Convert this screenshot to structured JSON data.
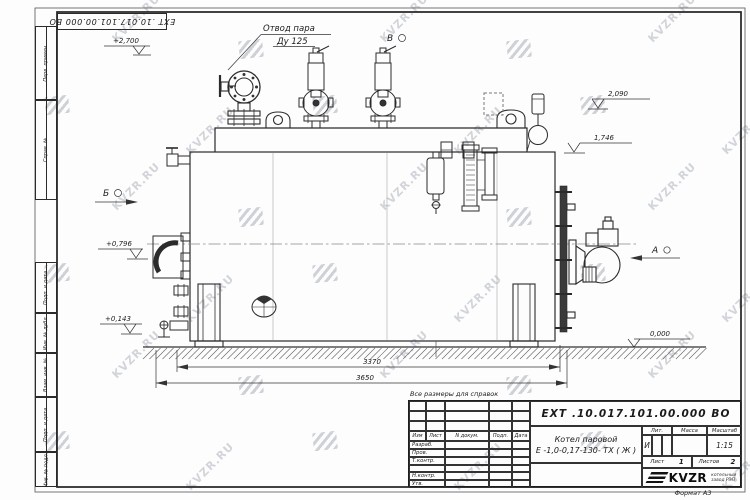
{
  "watermark": {
    "text": "KVZR.RU"
  },
  "top_stamp": {
    "designation": "ЕХТ .10.017.101.00.000  ВО"
  },
  "margin_columns": [
    {
      "label": "Перв. примен."
    },
    {
      "label": "Справ. №"
    },
    {
      "label": "Подп. и дата"
    },
    {
      "label": "Инв. № дубл."
    },
    {
      "label": "Взам. инв. №"
    },
    {
      "label": "Подп. и дата"
    },
    {
      "label": "Инв. № подл."
    }
  ],
  "drawing": {
    "labels": {
      "steam_outlet_line1": "Отвод пара",
      "steam_outlet_line2": "Ду 125",
      "view_a": "А",
      "view_b": "Б",
      "view_v": "В"
    },
    "elevations": {
      "e2700": "+2,700",
      "e2090": "2,090",
      "e1746": "1,746",
      "e0796": "+0,796",
      "e0143": "+0,143",
      "e0000": "0,000"
    },
    "dims": {
      "d3370": "3370",
      "d3650": "3650"
    }
  },
  "note": "Все размеры для справок",
  "title_block": {
    "designation": "ЕХТ .10.017.101.00.000  ВО",
    "product_name_1": "Котел паровой",
    "product_name_2": "Е -1,0-0,17-130- ТХ ( Ж )",
    "rev_header": {
      "izm": "Изм",
      "list": "Лист",
      "ndoc": "N докум.",
      "podp": "Подп.",
      "data": "Дата"
    },
    "row_labels": {
      "razrab": "Разраб.",
      "prov": "Пров.",
      "tkontr": "Т.контр.",
      "nkontr": "Н.контр.",
      "utv": "Утв."
    },
    "lit": {
      "label": "Лит.",
      "value": "И"
    },
    "massa": {
      "label": "Масса",
      "value": ""
    },
    "masshtab": {
      "label": "Масштаб",
      "value": "1:15"
    },
    "sheet": {
      "label": "Лист",
      "value": "1"
    },
    "sheets": {
      "label": "Листов",
      "value": "2"
    },
    "logo": {
      "name": "KVZR",
      "sub1": "котельный",
      "sub2": "завод РЭП"
    },
    "format": "Формат А3"
  }
}
